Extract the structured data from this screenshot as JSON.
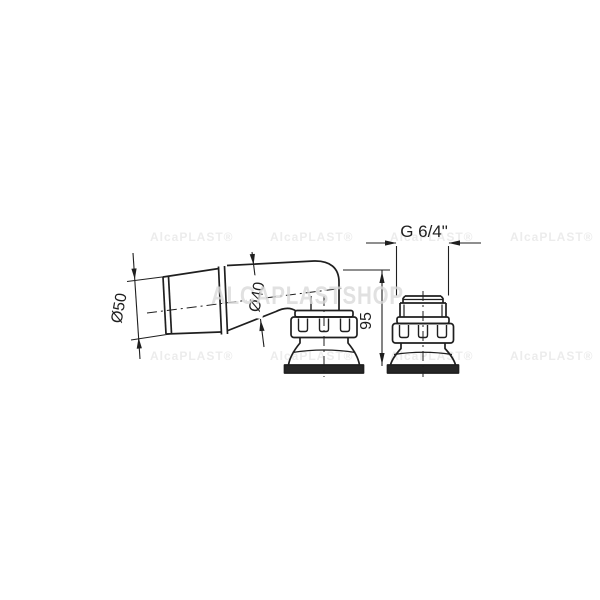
{
  "drawing": {
    "type": "technical-dimension-drawing",
    "views": [
      "side-view-elbow",
      "front-view"
    ],
    "line_color": "#1f1f1f",
    "background_color": "#ffffff",
    "dimensions": {
      "socket_diameter": "Ø50",
      "pipe_diameter": "Ø40",
      "height": "95",
      "thread": "G 6/4\""
    }
  },
  "watermarks": {
    "large": "ALCAPLASTSHOP",
    "small": "AlcaPLAST®"
  }
}
